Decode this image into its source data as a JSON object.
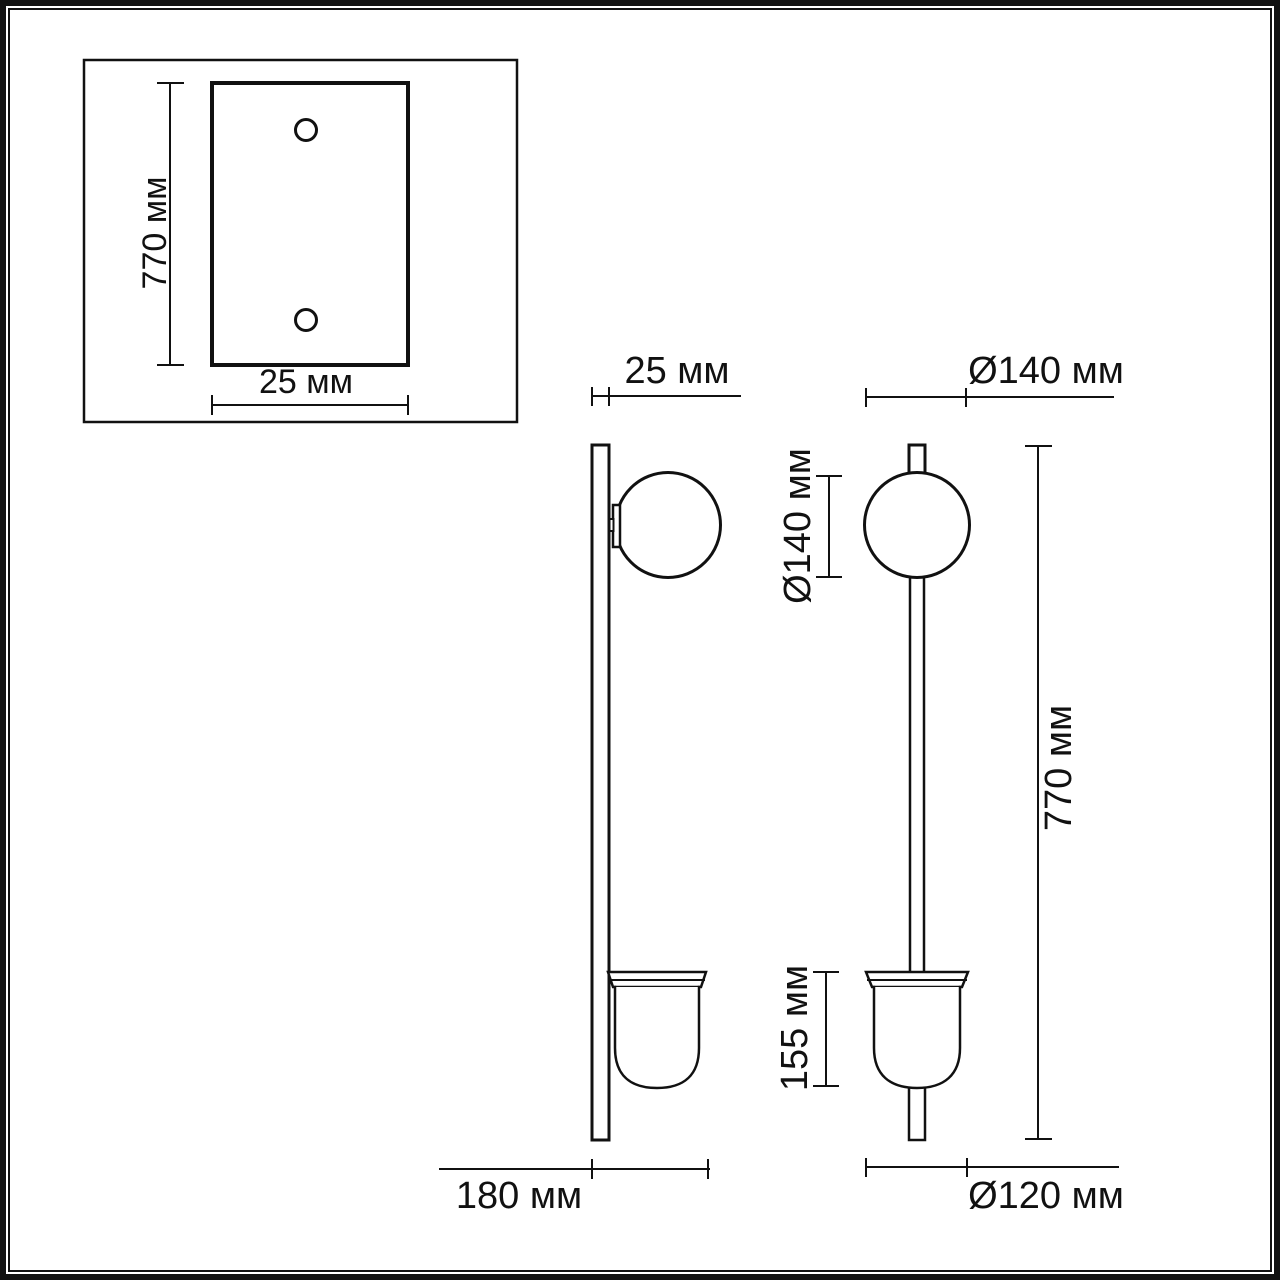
{
  "page": {
    "background": "#ffffff",
    "line_color": "#111111"
  },
  "mounting_plate_view": {
    "height_label": "770 мм",
    "width_label": "25 мм"
  },
  "side_view": {
    "plate_thickness_label": "25 мм",
    "protrusion_label": "180 мм"
  },
  "front_view": {
    "globe_diameter_label": "Ø140 мм",
    "globe_height_label": "Ø140 мм",
    "shade_height_label": "155 мм",
    "total_height_label": "770 мм",
    "shade_diameter_label": "Ø120 мм"
  }
}
